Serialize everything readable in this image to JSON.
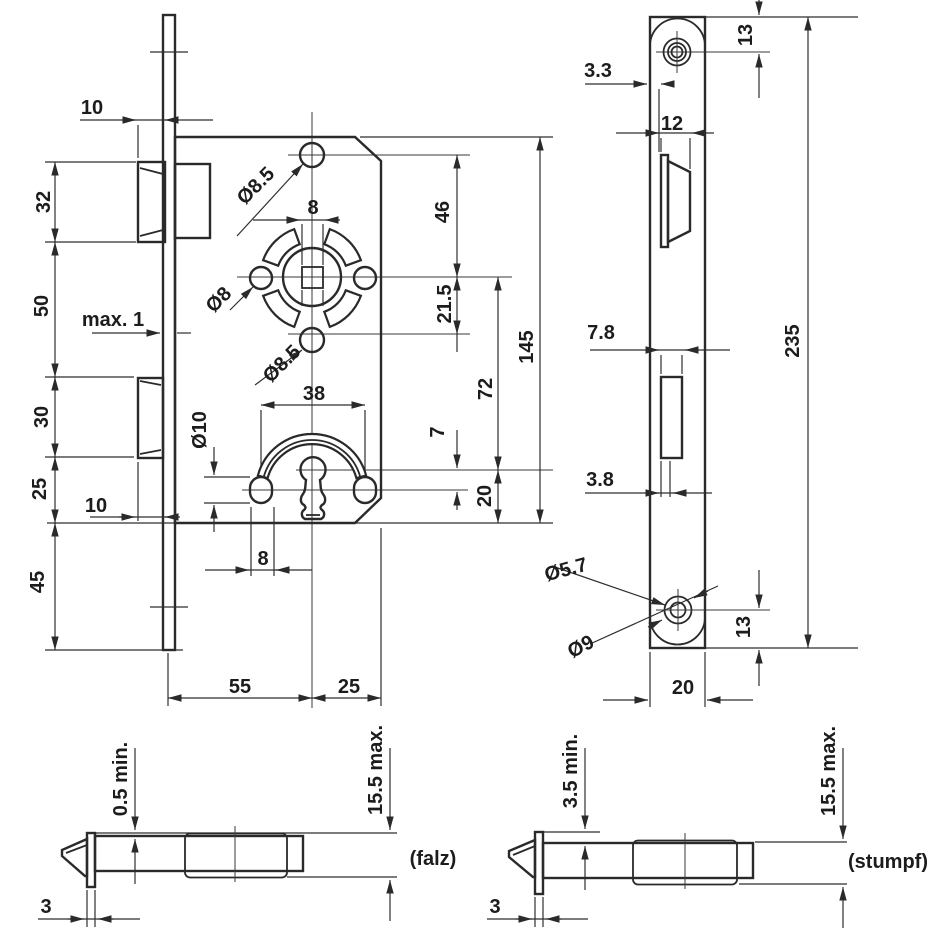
{
  "drawing_title": "mortise-lock-dimension-drawing",
  "front_view": {
    "dim_latch_projection": "10",
    "dim_latch_height": "32",
    "dim_latch_to_deadbolt": "50",
    "dim_plate_gap": "max. 1",
    "dim_deadbolt_height": "30",
    "dim_deadbolt_to_bottom": "25",
    "dim_deadbolt_projection": "10",
    "dim_plate_overhang": "45",
    "dia_top_hole": "Ø8.5",
    "dim_spindle_square": "8",
    "dia_side_hole": "Ø8",
    "dia_lower_hole": "Ø8.5",
    "dim_spring_span": "38",
    "dia_guide_hole": "Ø10",
    "dim_guide_width": "8",
    "dim_top_hole_to_follower": "46",
    "dim_follower_to_lower_hole": "21.5",
    "dim_follower_to_keyhole": "72",
    "dim_case_height": "145",
    "dim_keyhole_offset": "7",
    "dim_keyhole_to_bottom": "20",
    "dim_backset": "55",
    "dim_case_depth": "25"
  },
  "side_view": {
    "dim_screw_top": "13",
    "dim_latch_face": "3.3",
    "dim_latch_depth": "12",
    "dim_slot_width": "7.8",
    "dim_plate_length": "235",
    "dim_slot_offset": "3.8",
    "dia_screw_hole": "Ø5.7",
    "dia_countersink": "Ø9",
    "dim_screw_bottom": "13",
    "dim_plate_width": "20"
  },
  "detail_falz": {
    "dim_min": "0.5 min.",
    "dim_max": "15.5 max.",
    "dim_thickness": "3",
    "caption": "(falz)"
  },
  "detail_stumpf": {
    "dim_min": "3.5 min.",
    "dim_max": "15.5 max.",
    "dim_thickness": "3",
    "caption": "(stumpf)"
  }
}
